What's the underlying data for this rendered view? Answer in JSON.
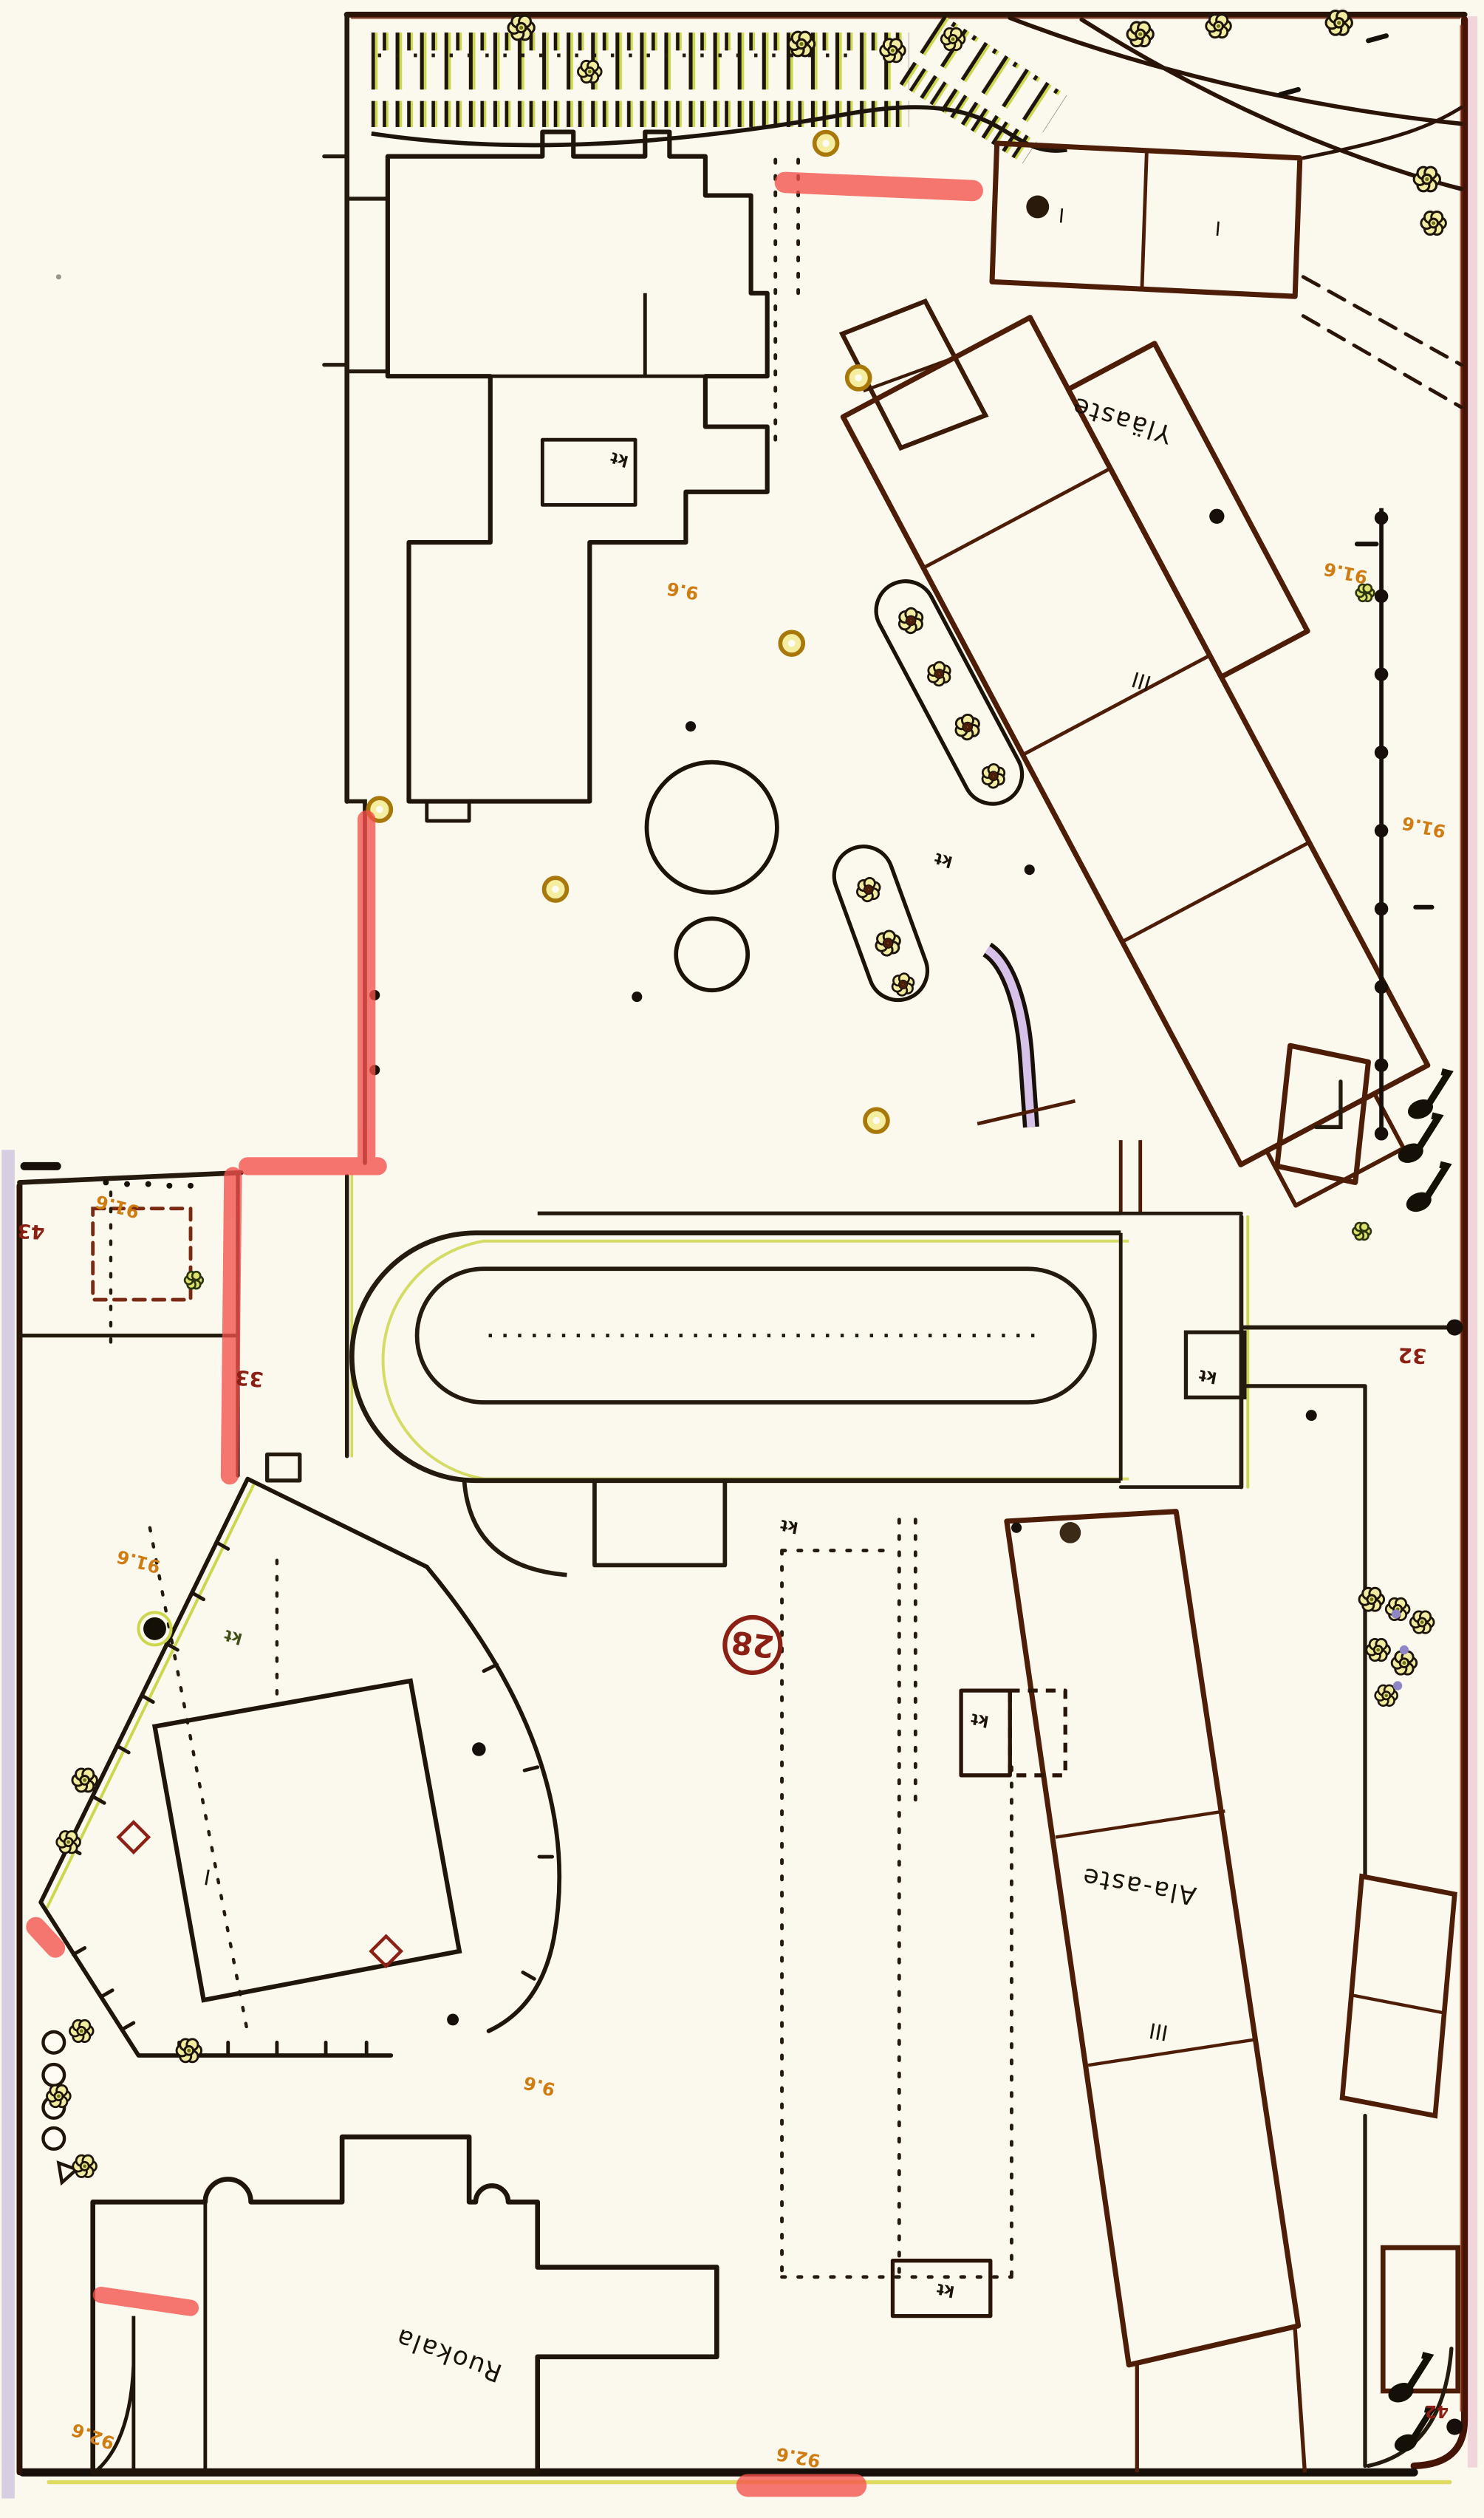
{
  "map": {
    "buildings": {
      "ylaaste": {
        "label": "Yläaste",
        "storeys": "III"
      },
      "ala_aste": {
        "label": "Ala-aste",
        "storeys": "III"
      },
      "ruokala": {
        "label": "Ruokala"
      },
      "north_wing_a": {
        "label": "I"
      },
      "north_wing_b": {
        "label": "I"
      },
      "yard_building": {
        "label": "I"
      }
    },
    "plot_numbers": {
      "site_circle": "28",
      "east": "32",
      "west": "33",
      "southeast": "42",
      "southwest": "43"
    },
    "spot_heights": {
      "northeast": "91.6",
      "east": "91.6",
      "west": "91.6",
      "yard": "91.6",
      "center": "9.6",
      "center_south": "9.6",
      "south": "92.6",
      "southwest": "92.6"
    },
    "annotations": {
      "kt": "kt"
    },
    "colors": {
      "paper": "#fbf8ee",
      "ink_black": "#1d150b",
      "building_brown": "#4d1d08",
      "marker_red": "#f4514b",
      "plot_number_red": "#8c2014",
      "spot_height_orange": "#cf7d12",
      "foliage_yellow": "#f2eca0",
      "foliage_green": "#ccd74e",
      "scan_violet": "#b4a3d6"
    }
  }
}
